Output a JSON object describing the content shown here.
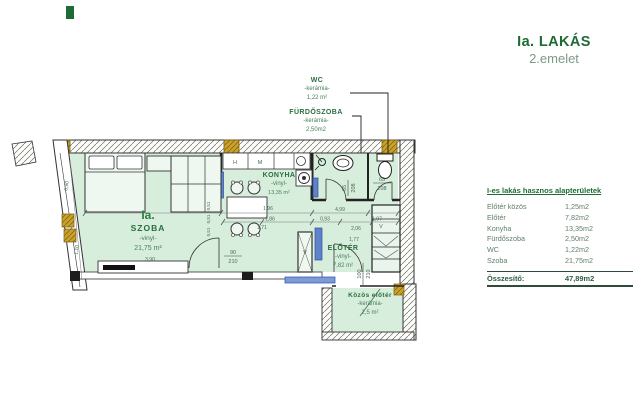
{
  "header": {
    "title": "Ia. LAKÁS",
    "subtitle": "2.emelet"
  },
  "plan": {
    "rooms": {
      "wc": {
        "name": "WC",
        "finish": "-kerámia-",
        "area": "1,22 m²"
      },
      "bathroom": {
        "name": "FÜRDŐSZOBA",
        "finish": "-kerámia-",
        "area": "2,50m2"
      },
      "kitchen": {
        "name": "KONYHA",
        "finish": "-vinyl-",
        "area": "13,35 m²"
      },
      "living_room": {
        "unit": "Ia.",
        "name": "SZOBA",
        "finish": "-vinyl-",
        "area": "21,75 m²"
      },
      "hall": {
        "name": "ELŐTÉR",
        "finish": "-vinyl-",
        "area": "7,82 m²"
      },
      "shared_hall": {
        "name": "Közös előtér",
        "finish": "-kerámia-",
        "area": "2,5 m²"
      }
    },
    "doors": {
      "room": {
        "w": "90",
        "h": "210"
      },
      "bathroom": {
        "w": "65",
        "h": "208"
      },
      "wc": {
        "w": "65",
        "h": "208"
      },
      "hall": {
        "w": "100",
        "h": "210"
      }
    },
    "appliances": {
      "fridge": "H",
      "washer": "M"
    },
    "shaft_mark": "V",
    "dims": {
      "d196": "1,96",
      "d186": "1,86",
      "d171": "1,71",
      "d499": "4,99",
      "d093": "0,93",
      "d197": "1,97",
      "d206": "2,06",
      "d177": "1,77",
      "d390": "3,90",
      "d051a": "0,51",
      "d051b": "0,51",
      "d051c": "0,51",
      "v090": "0,90",
      "v110": "1,10"
    }
  },
  "area_table": {
    "title": "I-es lakás hasznos alapterületek",
    "rows": [
      {
        "label": "Előtér közös",
        "value": "1,25m2"
      },
      {
        "label": "Előtér",
        "value": "7,82m2"
      },
      {
        "label": "Konyha",
        "value": "13,35m2"
      },
      {
        "label": "Fürdőszoba",
        "value": "2,50m2"
      },
      {
        "label": "WC",
        "value": "1,22m2"
      },
      {
        "label": "Szoba",
        "value": "21,75m2"
      }
    ],
    "total_label": "Összesítő:",
    "total_value": "47,89m2"
  },
  "colors": {
    "accent_green": "#1e6b35",
    "subtitle_green": "#7d9a88",
    "floor_mint": "#d8eedd",
    "wall_gold": "#c9a22c",
    "door_blue": "#5f82c8"
  }
}
